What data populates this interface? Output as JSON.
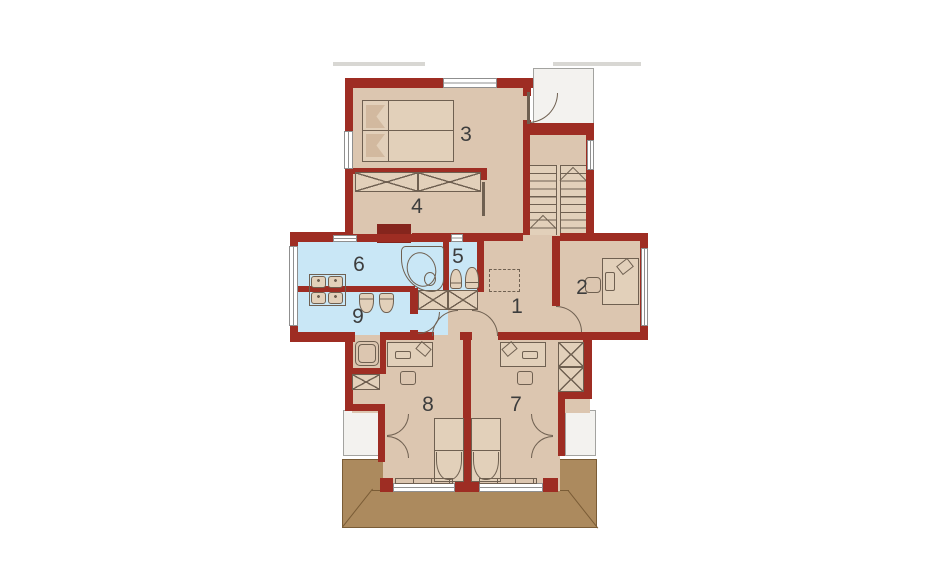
{
  "plan": {
    "type": "floor-plan",
    "room_labels": [
      {
        "number": "1"
      },
      {
        "number": "2"
      },
      {
        "number": "3"
      },
      {
        "number": "4"
      },
      {
        "number": "5"
      },
      {
        "number": "6"
      },
      {
        "number": "7"
      },
      {
        "number": "8"
      },
      {
        "number": "9"
      }
    ],
    "colors": {
      "wall": "#9e2d23",
      "wall_dark": "#85251d",
      "floor": "#dcc6b0",
      "floor2": "#e2d0ba",
      "bath": "#c9e7f6",
      "terrace": "#ac8a5e",
      "terrace_line": "#7a5c36",
      "roof_white": "#f3f2ef",
      "roof_border": "#a3a3a0",
      "line": "#6f6051",
      "label": "#3d3d3d",
      "win_frame": "#8f8f8f",
      "roof_hint": "#d8d7d3"
    }
  }
}
